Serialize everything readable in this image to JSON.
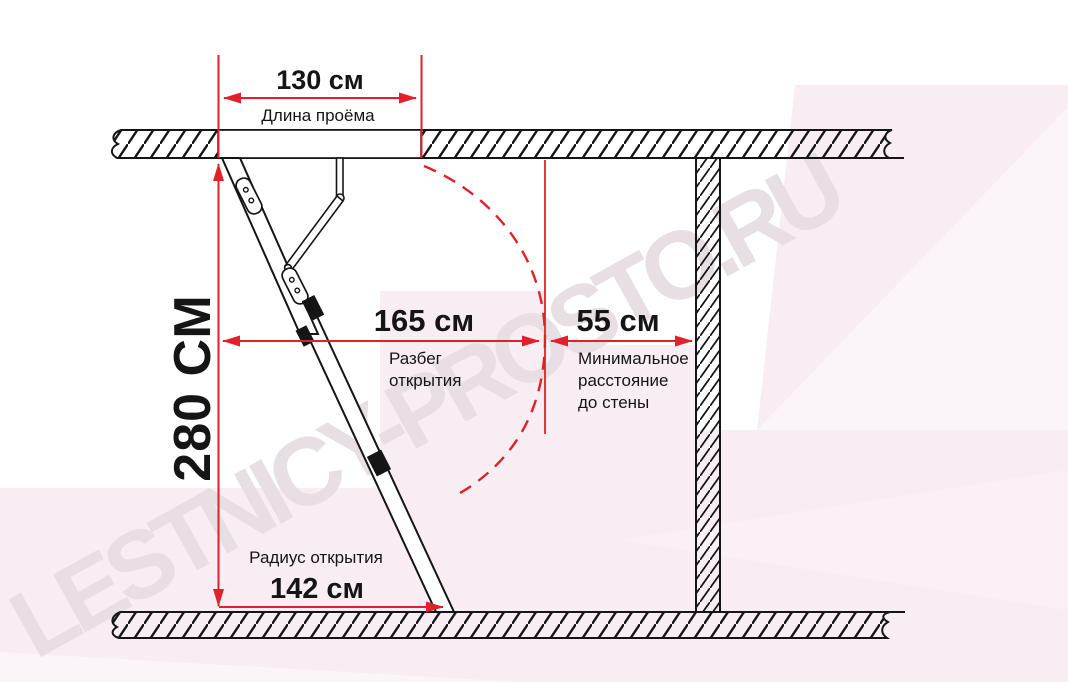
{
  "title": "Attic ladder opening dimensions diagram",
  "watermark": {
    "text": "LESTNICY-PROSTO.RU"
  },
  "colors": {
    "dimension_red": "#e2202a",
    "line_black": "#151515",
    "background_pink": "#f8edf3",
    "background_pink_light": "#fbf4f8",
    "watermark_gray": "#e7dfe3"
  },
  "dimensions": {
    "opening_length": {
      "value": "130 см",
      "label": "Длина проёма"
    },
    "ceiling_height": {
      "value": "280 СМ"
    },
    "opening_span": {
      "value": "165 см",
      "label_lines": [
        "Разбег",
        "открытия"
      ]
    },
    "wall_clearance": {
      "value": "55 см",
      "label_lines": [
        "Минимальное",
        "расстояние",
        "до стены"
      ]
    },
    "opening_radius": {
      "value": "142 см",
      "label": "Радиус открытия"
    }
  }
}
